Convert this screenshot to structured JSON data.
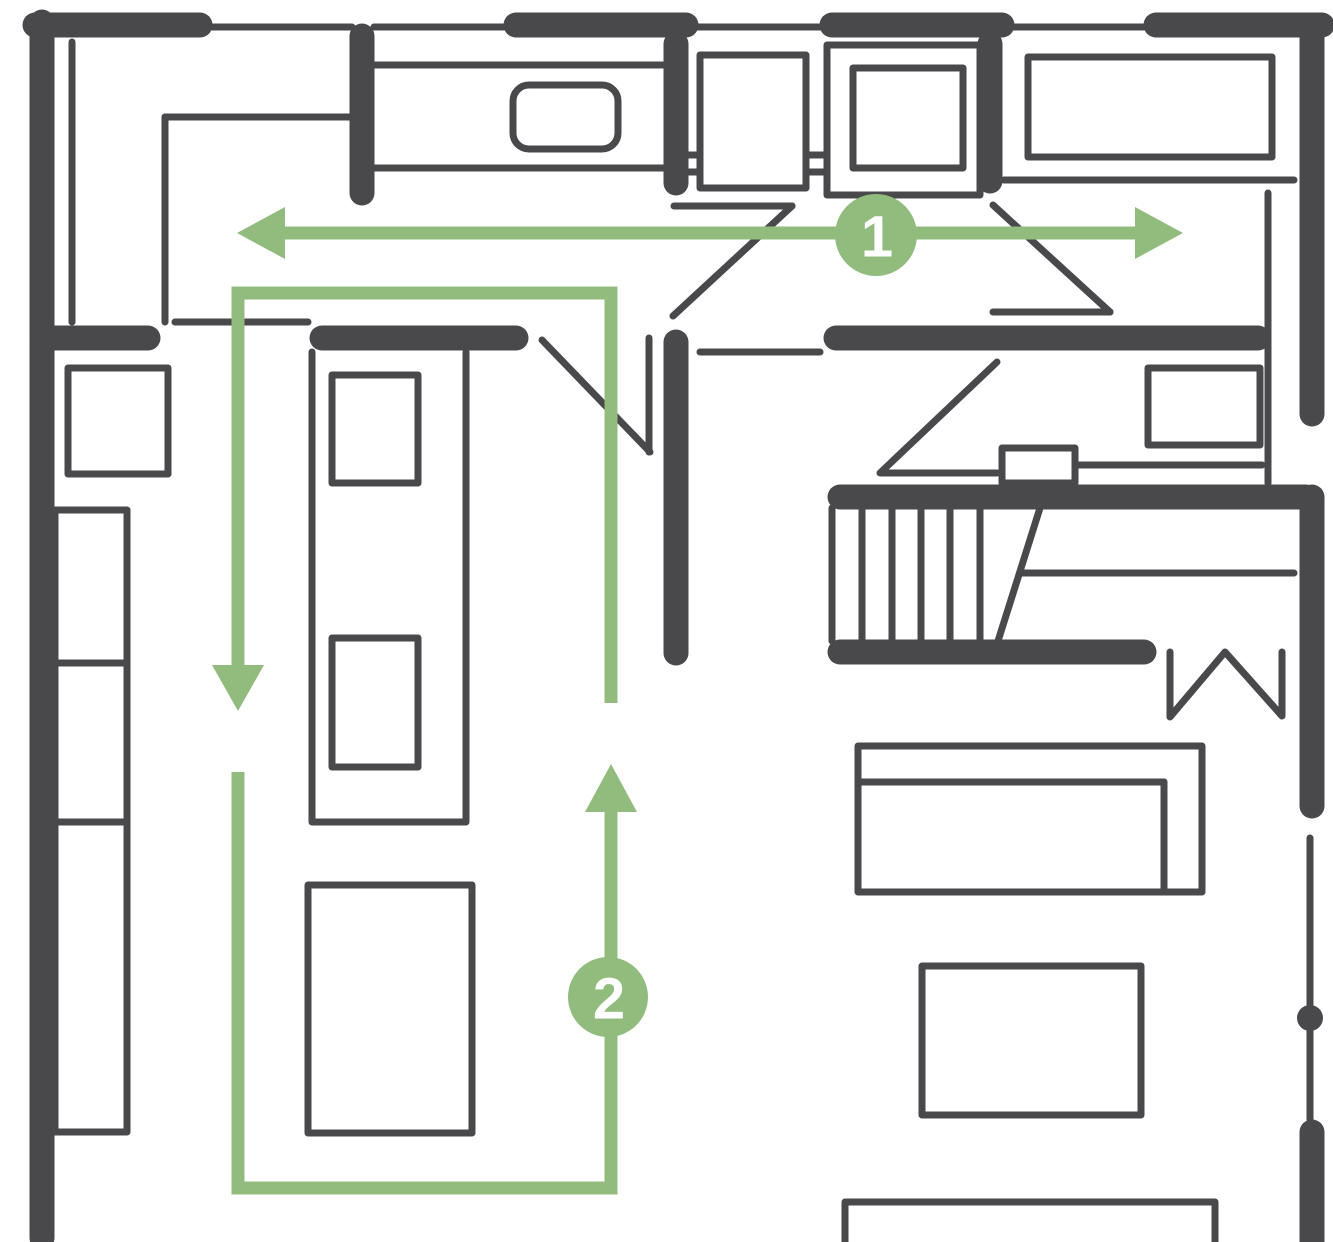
{
  "colors": {
    "wall": "#49494c",
    "accent_green": "#92bc7e",
    "badge_text": "#ffffff",
    "background": "#ffffff"
  },
  "flow_markers": [
    {
      "label": "1",
      "cx": 876,
      "cy": 235,
      "r": 41
    },
    {
      "label": "2",
      "cx": 608,
      "cy": 997,
      "r": 40
    }
  ],
  "floorplan": {
    "width": 1333,
    "height": 1242,
    "shapes": [
      {
        "n": "counter-window-line-1",
        "k": "line",
        "c": "thin",
        "w": 5,
        "p": [
          202,
          27,
          352,
          27
        ]
      },
      {
        "n": "counter-window-line-2",
        "k": "line",
        "c": "thin",
        "w": 5,
        "p": [
          374,
          27,
          514,
          27
        ]
      },
      {
        "n": "counter-window-line-3",
        "k": "line",
        "c": "thin",
        "w": 5,
        "p": [
          688,
          27,
          830,
          27
        ]
      },
      {
        "n": "counter-window-line-4",
        "k": "line",
        "c": "thin",
        "w": 5,
        "p": [
          1004,
          27,
          1154,
          27
        ]
      },
      {
        "n": "kitchen-counter-top-edge",
        "k": "line",
        "c": "thin",
        "p": [
          374,
          65,
          664,
          65
        ]
      },
      {
        "n": "kitchen-counter-front-edge",
        "k": "line",
        "c": "thin",
        "p": [
          374,
          168,
          664,
          168
        ]
      },
      {
        "n": "appliance-counter-line-1",
        "k": "line",
        "c": "thin",
        "w": 5,
        "p": [
          688,
          155,
          976,
          155
        ]
      },
      {
        "n": "appliance-counter-line-2",
        "k": "line",
        "c": "thin",
        "p": [
          688,
          172,
          976,
          172
        ]
      },
      {
        "n": "right-counter-front-edge",
        "k": "line",
        "c": "thin",
        "w": 8,
        "p": [
          1004,
          180,
          1294,
          180
        ]
      },
      {
        "n": "left-wall-inner-line",
        "k": "line",
        "c": "thin",
        "w": 6,
        "p": [
          72,
          42,
          72,
          322
        ]
      },
      {
        "n": "pantry-side-line",
        "k": "line",
        "c": "thin",
        "p": [
          165,
          117,
          165,
          322
        ]
      },
      {
        "n": "pantry-top-line",
        "k": "line",
        "c": "thin",
        "p": [
          165,
          117,
          350,
          117
        ]
      },
      {
        "n": "opening-threshold-left",
        "k": "line",
        "c": "thin",
        "p": [
          175,
          322,
          308,
          322
        ]
      },
      {
        "n": "opening-threshold-mid",
        "k": "line",
        "c": "thin",
        "p": [
          700,
          352,
          820,
          352
        ]
      },
      {
        "n": "right-room-divider-line",
        "k": "line",
        "c": "thin",
        "p": [
          1268,
          193,
          1268,
          483
        ]
      },
      {
        "n": "entry-cabinet-line",
        "k": "line",
        "c": "thin",
        "p": [
          1075,
          465,
          1262,
          465
        ]
      },
      {
        "n": "stair-landing-line",
        "k": "line",
        "c": "thin",
        "p": [
          1022,
          573,
          1294,
          573
        ]
      },
      {
        "n": "stair-tread-1",
        "k": "line",
        "c": "thin",
        "p": [
          832,
          508,
          832,
          641
        ]
      },
      {
        "n": "stair-tread-2",
        "k": "line",
        "c": "thin",
        "p": [
          862,
          508,
          862,
          641
        ]
      },
      {
        "n": "stair-tread-3",
        "k": "line",
        "c": "thin",
        "p": [
          892,
          508,
          892,
          641
        ]
      },
      {
        "n": "stair-tread-4",
        "k": "line",
        "c": "thin",
        "p": [
          921,
          508,
          921,
          641
        ]
      },
      {
        "n": "stair-tread-5",
        "k": "line",
        "c": "thin",
        "p": [
          950,
          508,
          950,
          641
        ]
      },
      {
        "n": "stair-tread-6",
        "k": "line",
        "c": "thin",
        "p": [
          980,
          508,
          980,
          641
        ]
      },
      {
        "n": "stair-break-line",
        "k": "line",
        "c": "thin",
        "p": [
          1040,
          508,
          998,
          641
        ]
      },
      {
        "n": "right-wall-thin-line",
        "k": "line",
        "c": "thin",
        "p": [
          1310,
          838,
          1310,
          1120
        ]
      },
      {
        "n": "door-leaf-island",
        "k": "line",
        "c": "thin",
        "p": [
          649,
          338,
          649,
          452
        ]
      },
      {
        "n": "door-swing-island",
        "k": "line",
        "c": "thin",
        "p": [
          542,
          340,
          650,
          452
        ]
      },
      {
        "n": "door-leaf-hall-left",
        "k": "line",
        "c": "thin",
        "p": [
          674,
          206,
          792,
          206
        ]
      },
      {
        "n": "door-swing-hall-left",
        "k": "line",
        "c": "thin",
        "p": [
          792,
          206,
          673,
          316
        ]
      },
      {
        "n": "door-swing-hall-right",
        "k": "line",
        "c": "thin",
        "p": [
          993,
          205,
          1110,
          312
        ]
      },
      {
        "n": "door-leaf-hall-right",
        "k": "line",
        "c": "thin",
        "p": [
          993,
          312,
          1110,
          312
        ]
      },
      {
        "n": "door-leaf-stair-room",
        "k": "line",
        "c": "thin",
        "p": [
          881,
          473,
          997,
          473
        ]
      },
      {
        "n": "door-swing-stair-room",
        "k": "line",
        "c": "thin",
        "p": [
          880,
          473,
          997,
          362
        ]
      },
      {
        "n": "island-outline",
        "k": "polyline",
        "c": "thin",
        "w": 8,
        "p": [
          312,
          352,
          312,
          822,
          466,
          822,
          466,
          352
        ]
      },
      {
        "n": "cabinet-divider-line",
        "k": "line",
        "c": "thin",
        "p": [
          94,
          824,
          94,
          1130
        ]
      },
      {
        "n": "zigzag-symbol",
        "k": "polyline",
        "c": "thin",
        "p": [
          1170,
          652,
          1170,
          717,
          1225,
          652,
          1282,
          716,
          1282,
          652
        ]
      },
      {
        "n": "sink",
        "k": "rect",
        "c": "furn",
        "rx": 16,
        "p": [
          513,
          85,
          105,
          64
        ]
      },
      {
        "n": "dishwasher",
        "k": "rect",
        "c": "furn",
        "p": [
          700,
          55,
          106,
          133
        ]
      },
      {
        "n": "stove-outer",
        "k": "rect",
        "c": "furn",
        "w": 5,
        "p": [
          827,
          45,
          153,
          150
        ]
      },
      {
        "n": "stove-inner",
        "k": "rect",
        "c": "furn",
        "p": [
          853,
          68,
          110,
          100
        ]
      },
      {
        "n": "fridge",
        "k": "rect",
        "c": "furn",
        "p": [
          1028,
          57,
          244,
          100
        ]
      },
      {
        "n": "tv-unit",
        "k": "rect",
        "c": "furn",
        "p": [
          1148,
          368,
          112,
          77
        ]
      },
      {
        "n": "entry-cabinet",
        "k": "rect",
        "c": "furn",
        "p": [
          1002,
          448,
          73,
          35
        ]
      },
      {
        "n": "island-appliance-1",
        "k": "rect",
        "c": "furn",
        "p": [
          332,
          375,
          86,
          108
        ]
      },
      {
        "n": "island-appliance-2",
        "k": "rect",
        "c": "furn",
        "p": [
          332,
          638,
          86,
          129
        ]
      },
      {
        "n": "dining-zone-rect",
        "k": "rect",
        "c": "furn",
        "w": 8,
        "p": [
          308,
          885,
          164,
          248
        ]
      },
      {
        "n": "window-box-left",
        "k": "rect",
        "c": "furn",
        "p": [
          68,
          368,
          100,
          106
        ]
      },
      {
        "n": "cabinet-upper",
        "k": "rect",
        "c": "furn",
        "p": [
          55,
          510,
          72,
          153
        ]
      },
      {
        "n": "cabinet-mid",
        "k": "rect",
        "c": "furn",
        "p": [
          55,
          663,
          72,
          159
        ]
      },
      {
        "n": "cabinet-tall",
        "k": "rect",
        "c": "furn",
        "p": [
          55,
          822,
          72,
          310
        ]
      },
      {
        "n": "sofa",
        "k": "rect",
        "c": "furn",
        "p": [
          858,
          746,
          344,
          146
        ]
      },
      {
        "n": "sofa-back-line",
        "k": "line",
        "c": "thin",
        "p": [
          858,
          782,
          1164,
          782
        ]
      },
      {
        "n": "sofa-arm-line",
        "k": "line",
        "c": "thin",
        "p": [
          1164,
          782,
          1164,
          892
        ]
      },
      {
        "n": "coffee-table",
        "k": "rect",
        "c": "furn",
        "w": 8,
        "p": [
          922,
          966,
          219,
          149
        ]
      },
      {
        "n": "media-rect-bottom",
        "k": "rect",
        "c": "furn",
        "w": 8,
        "p": [
          845,
          1202,
          370,
          70
        ]
      },
      {
        "n": "wall-top-seg-1",
        "k": "line",
        "c": "wall",
        "p": [
          35,
          25,
          200,
          25
        ]
      },
      {
        "n": "wall-top-seg-2",
        "k": "line",
        "c": "wall",
        "p": [
          516,
          25,
          686,
          25
        ]
      },
      {
        "n": "wall-top-seg-3",
        "k": "line",
        "c": "wall",
        "p": [
          832,
          25,
          1002,
          25
        ]
      },
      {
        "n": "wall-top-seg-4",
        "k": "line",
        "c": "wall",
        "p": [
          1156,
          25,
          1322,
          25
        ]
      },
      {
        "n": "wall-left",
        "k": "line",
        "c": "wall",
        "p": [
          42,
          22,
          42,
          1238
        ]
      },
      {
        "n": "wall-kitchen-divider-1",
        "k": "line",
        "c": "wall",
        "p": [
          362,
          36,
          362,
          193
        ]
      },
      {
        "n": "wall-kitchen-divider-2",
        "k": "line",
        "c": "wall",
        "p": [
          676,
          44,
          676,
          183
        ]
      },
      {
        "n": "wall-kitchen-divider-3",
        "k": "line",
        "c": "wall",
        "p": [
          990,
          44,
          990,
          181
        ]
      },
      {
        "n": "wall-right-upper",
        "k": "line",
        "c": "wall",
        "p": [
          1312,
          28,
          1312,
          414
        ]
      },
      {
        "n": "wall-mid-horizontal",
        "k": "line",
        "c": "wall",
        "p": [
          836,
          338,
          1258,
          338
        ]
      },
      {
        "n": "wall-hallway",
        "k": "line",
        "c": "wall",
        "p": [
          676,
          342,
          676,
          653
        ]
      },
      {
        "n": "wall-left-stub",
        "k": "line",
        "c": "wall",
        "p": [
          44,
          338,
          148,
          338
        ]
      },
      {
        "n": "wall-island-header",
        "k": "line",
        "c": "wall",
        "p": [
          322,
          338,
          516,
          338
        ]
      },
      {
        "n": "wall-stairs-top",
        "k": "line",
        "c": "wall",
        "w": 22,
        "p": [
          840,
          497,
          1306,
          497
        ]
      },
      {
        "n": "wall-stairs-bottom",
        "k": "line",
        "c": "wall",
        "w": 22,
        "p": [
          840,
          652,
          1144,
          652
        ]
      },
      {
        "n": "wall-right-mid",
        "k": "line",
        "c": "wall",
        "p": [
          1312,
          497,
          1312,
          806
        ]
      },
      {
        "n": "wall-right-lower",
        "k": "line",
        "c": "wall",
        "p": [
          1312,
          1132,
          1312,
          1246
        ]
      },
      {
        "n": "wall-door-dot",
        "k": "circle",
        "c": "dot",
        "p": [
          1310,
          1018,
          13
        ]
      },
      {
        "n": "circulation-arrow-1-shaft",
        "k": "line",
        "c": "green",
        "p": [
          280,
          233,
          1140,
          233
        ]
      },
      {
        "n": "circulation-arrow-1-head-left",
        "k": "polygon",
        "c": "greenfill",
        "p": [
          237,
          233,
          285,
          207,
          285,
          259
        ]
      },
      {
        "n": "circulation-arrow-1-head-right",
        "k": "polygon",
        "c": "greenfill",
        "p": [
          1183,
          233,
          1135,
          207,
          1135,
          259
        ]
      },
      {
        "n": "circulation-loop-2-upper",
        "k": "polyline",
        "c": "green",
        "p": [
          238,
          667,
          238,
          293,
          611,
          293,
          611,
          703
        ]
      },
      {
        "n": "circulation-loop-2-head-down",
        "k": "polygon",
        "c": "greenfill",
        "p": [
          238,
          711,
          212,
          665,
          264,
          665
        ]
      },
      {
        "n": "circulation-loop-2-lower",
        "k": "polyline",
        "c": "green",
        "p": [
          238,
          772,
          238,
          1188,
          611,
          1188,
          611,
          812
        ]
      },
      {
        "n": "circulation-loop-2-head-up",
        "k": "polygon",
        "c": "greenfill",
        "p": [
          611,
          764,
          585,
          812,
          637,
          812
        ]
      },
      {
        "n": "badge-1-circle",
        "k": "circle",
        "c": "badge",
        "p": [
          876,
          235,
          41
        ]
      },
      {
        "n": "badge-1-label",
        "k": "text",
        "c": "badge-label",
        "p": [
          876,
          237
        ],
        "bind": "flow_markers.0.label"
      },
      {
        "n": "badge-2-circle",
        "k": "circle",
        "c": "badge",
        "p": [
          608,
          997,
          40
        ]
      },
      {
        "n": "badge-2-label",
        "k": "text",
        "c": "badge-label",
        "p": [
          608,
          999
        ],
        "bind": "flow_markers.1.label"
      }
    ]
  }
}
